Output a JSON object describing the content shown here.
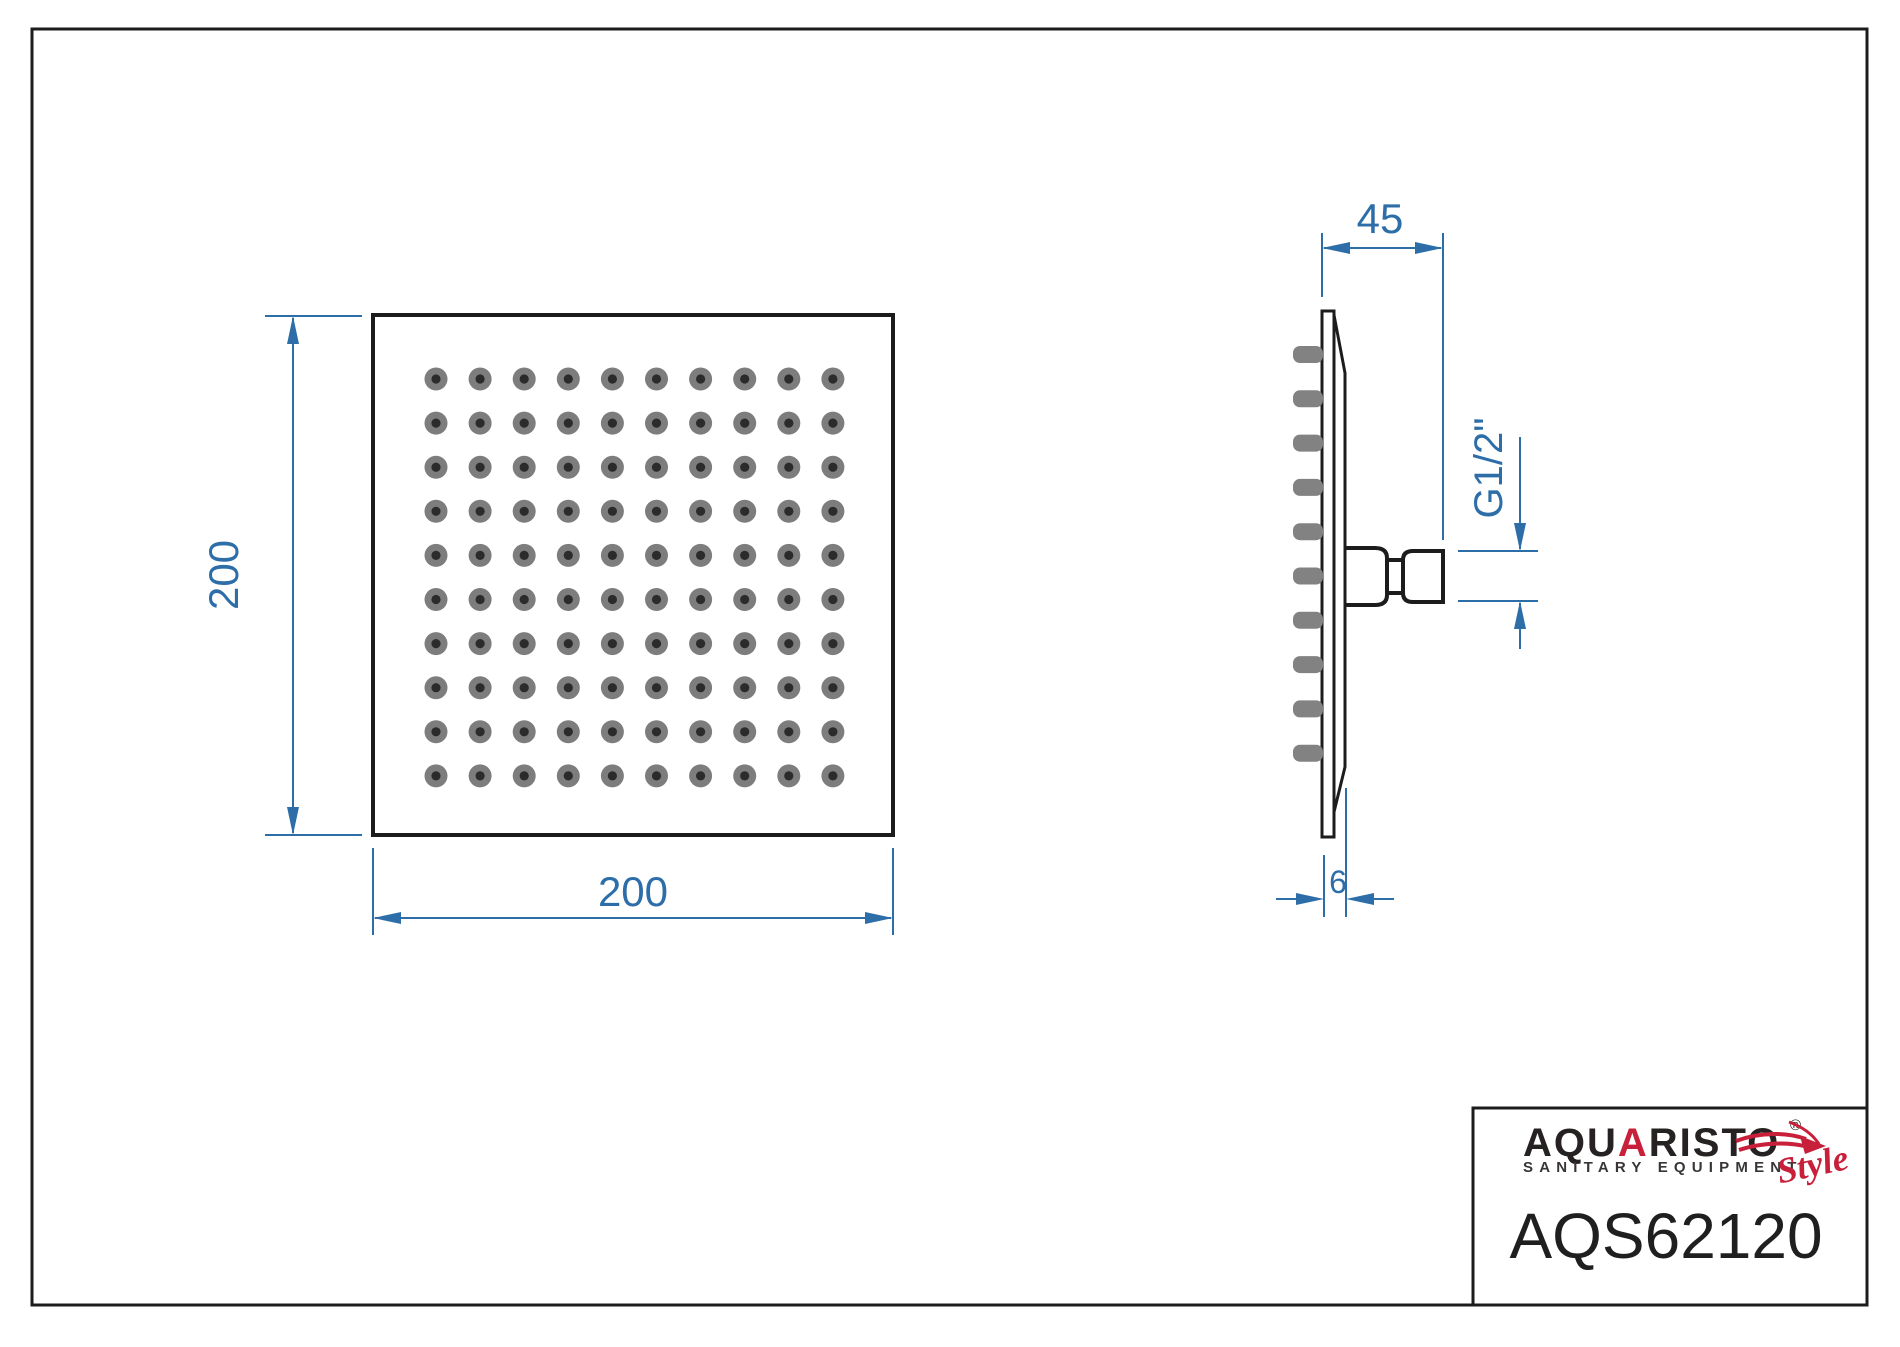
{
  "drawing": {
    "background_color": "#ffffff",
    "line_color": "#1c1c1c",
    "dimension_color": "#2d6ea9",
    "dims": {
      "front_height": "200",
      "front_width": "200",
      "side_depth": "45",
      "plate_thickness": "6",
      "thread_size": "G1/2\""
    },
    "front_view": {
      "hole_rows": 10,
      "hole_cols": 10,
      "hole_outer_color": "#7d7d7d",
      "hole_inner_color": "#2b2b2b"
    },
    "side_view": {
      "nozzle_count": 10,
      "nozzle_color": "#828282"
    }
  },
  "title_block": {
    "brand_part1": "AQU",
    "brand_accent": "A",
    "brand_part2": "RISTO",
    "registered_mark": "®",
    "tagline": "SANITARY EQUIPMENT",
    "style_script": "Style",
    "model_number": "AQS62120",
    "brand_dark_color": "#262222",
    "brand_red_color": "#c8203a"
  }
}
